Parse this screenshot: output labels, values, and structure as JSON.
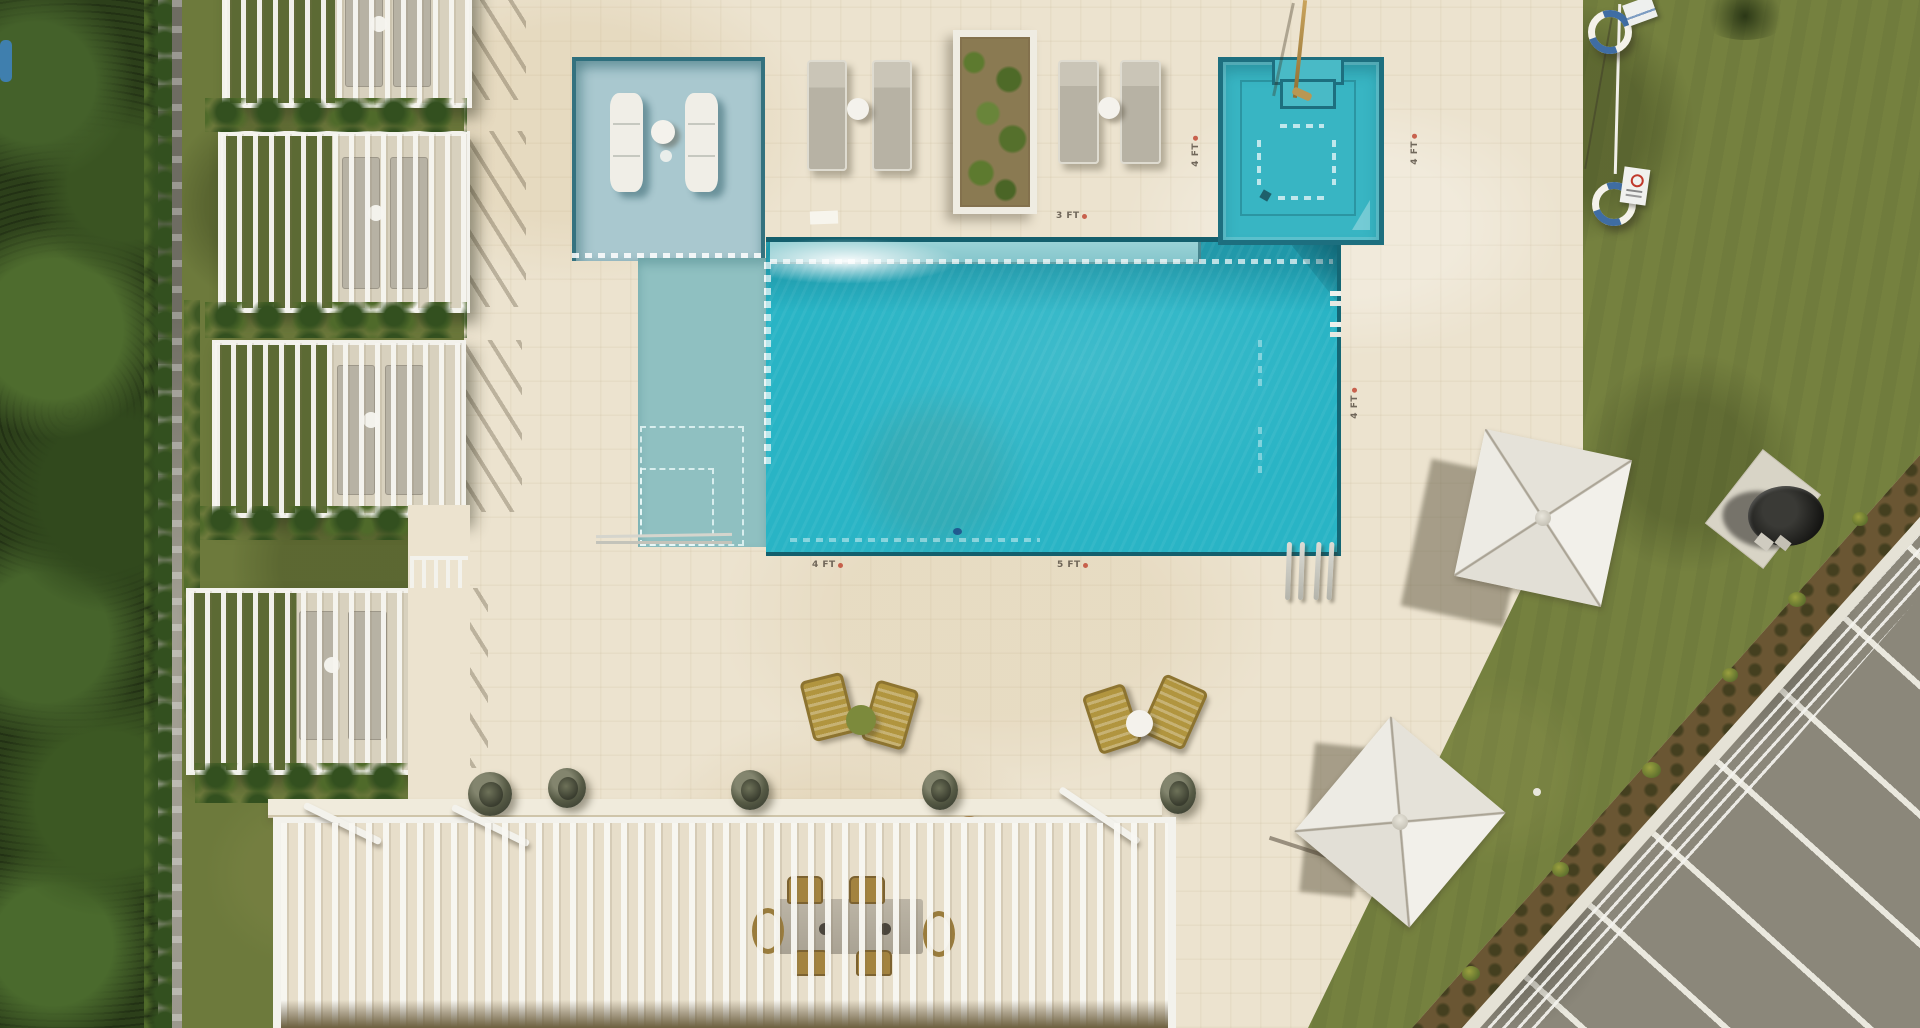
{
  "depth_markers": [
    {
      "id": "marker-3ft-pool-top",
      "label": "3 FT"
    },
    {
      "id": "marker-4ft-spa-left",
      "label": "4 FT"
    },
    {
      "id": "marker-4ft-spa-right",
      "label": "4 FT"
    },
    {
      "id": "marker-4ft-pool-right",
      "label": "4 FT"
    },
    {
      "id": "marker-4ft-pool-bottom",
      "label": "4 FT"
    },
    {
      "id": "marker-5ft-pool-bottom",
      "label": "5 FT"
    }
  ],
  "colors": {
    "deck": "#ece3cf",
    "white": "#f3f2ec",
    "pool": "#29b4c5",
    "poolrim": "#135f6d",
    "ledge": "#a9c8cf",
    "shelf": "#8fc0c1",
    "bench": "#86c6cc",
    "spa": "#38b5c3",
    "grass": "#75813f",
    "grassL": "#6d7a3c",
    "trees": "#2c3f1a",
    "wall": "#9b988d",
    "park": "#8b877a",
    "mulch": "#6a5633",
    "stripe": "#eae8de",
    "rattan": "#b1953f",
    "bronze": "#a3833f",
    "tgreen": "#7c8a3c",
    "lounger": "#b7b2a4",
    "metal": "#c6c6bf"
  }
}
